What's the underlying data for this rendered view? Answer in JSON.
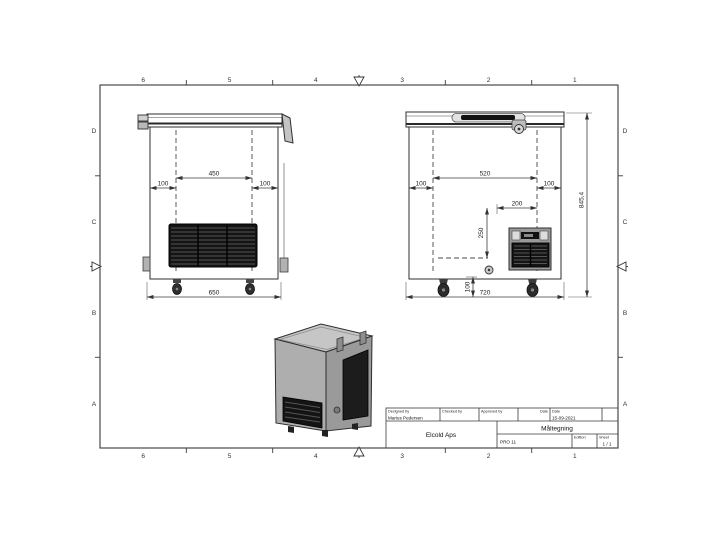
{
  "frame": {
    "top_labels": [
      "6",
      "5",
      "4",
      "3",
      "2",
      "1"
    ],
    "bottom_labels": [
      "6",
      "5",
      "4",
      "3",
      "2",
      "1"
    ],
    "left_labels": [
      "D",
      "C",
      "B",
      "A"
    ],
    "right_labels": [
      "D",
      "C",
      "B",
      "A"
    ]
  },
  "rear_view": {
    "dim_inner_width": "450",
    "dim_left_inset": "100",
    "dim_right_inset": "100",
    "dim_overall_width": "650"
  },
  "front_view": {
    "dim_inner_width": "520",
    "dim_left_inset": "100",
    "dim_right_inset": "100",
    "dim_offset_x": "200",
    "dim_offset_y": "250",
    "dim_bottom_offset": "100",
    "dim_overall_width": "720",
    "dim_overall_height": "845,4"
  },
  "title_block": {
    "designed_by_label": "Designed by",
    "designed_by_value": "Marius Pedersen",
    "checked_by_label": "Checked by",
    "approved_by_label": "Approved by",
    "date1_label": "Date",
    "date2_label": "Date",
    "date_value": "15-09-2021",
    "company": "Elcold Aps",
    "drawing_title": "Måltegning",
    "drawing_number": "PRO 11",
    "edition_label": "Edition",
    "sheet_label": "Sheet",
    "sheet_value": "1 / 1"
  },
  "colors": {
    "body_fill": "#b2b2b2",
    "lid_fill": "#cccccc",
    "grille_fill": "#141414",
    "line": "#3a3a3a",
    "background": "#ffffff"
  }
}
